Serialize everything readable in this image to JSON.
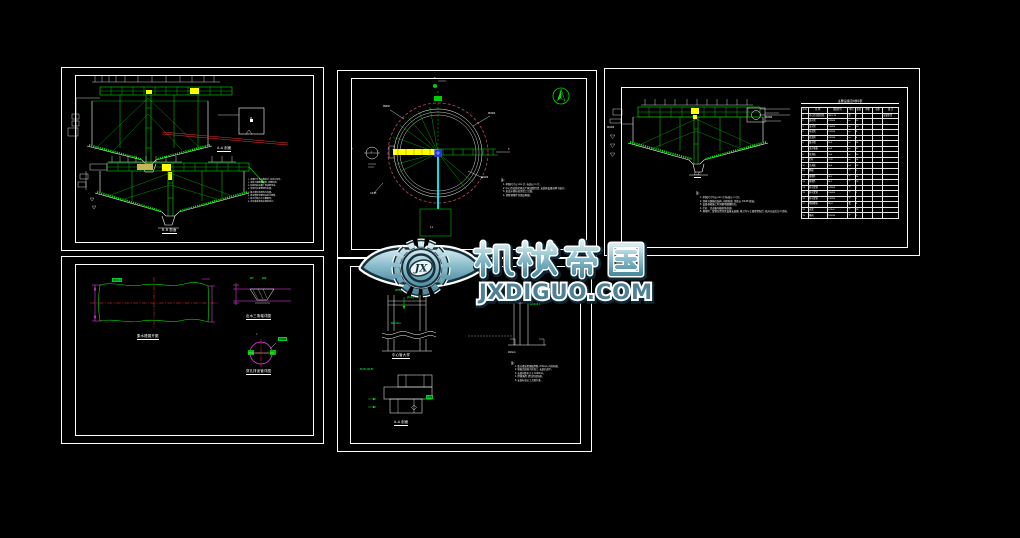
{
  "watermark": {
    "logo_monogram": "JX",
    "brand": "机械帝国",
    "domain": "JXDIGUO.COM",
    "color_main": "#4e8ea6",
    "color_light": "#d8ecf1",
    "color_dark": "#16313c"
  },
  "panels": {
    "p1": {
      "title_top": "A-A 剖面",
      "title_bottom": "B-B 剖面",
      "box_label": "M",
      "notes": [
        "1. 本图尺寸均以毫米计, 标高以米计。",
        "2. 池体为钢筋砼结构, 内壁防腐。",
        "3. 刮泥机由设备厂家成套供货。",
        "4. 安装时注意预埋件位置。",
        "5. 集水槽沿池周均匀布置。",
        "6. 排泥管穿池壁处设防水套管。",
        "7. 施工时请与工艺图配合。",
        "8. 未尽事宜按有关规范执行。"
      ]
    },
    "p2": {
      "cut_label_top": "F",
      "cut_label_left": "T",
      "cut_label_right": "T",
      "detail_box_label": "J-1",
      "section_mark": "1",
      "dims": [
        "DN500",
        "DN200",
        "R9000",
        "i=0.05"
      ],
      "notes_heading": "注:",
      "notes": [
        "1. 本图尺寸以 mm 计, 标高以 m 计。",
        "2. 中心传动刮泥机由厂家成套供货, 安装按设备说明书进行。",
        "3. 进出水管标高详见工艺图。",
        "4. 池壁预埋件详见结构图。"
      ]
    },
    "p3": {
      "section_title": "C-C",
      "dims": [
        "DN500",
        "DN200"
      ],
      "notes_heading": "注:",
      "notes": [
        "1. 本图尺寸均以 mm 计(标高以 m 计)。",
        "2. 池体为钢筋砼结构, 内壁防腐, 池底以 i=0.05 找坡。",
        "3. 设备基础施工时预留地脚螺栓孔。",
        "4. 栏杆、走道板均做防锈处理。",
        "5. 预埋件、套管位置详见设备安装图, 施工时与土建密切配合, 核对无误后方可浇筑。"
      ],
      "table": {
        "title": "主要设备及材料表",
        "headers": [
          "序号",
          "名 称",
          "规格型号",
          "单位",
          "数量",
          "单重",
          "总重",
          "备 注"
        ],
        "rows": [
          [
            "1",
            "中心传动刮泥机",
            "ZBG-18",
            "台",
            "1",
            "",
            "",
            "成套供货"
          ],
          [
            "2",
            "进水管",
            "DN500",
            "m",
            "12",
            "",
            "",
            ""
          ],
          [
            "3",
            "出水管",
            "DN400",
            "m",
            "10",
            "",
            "",
            ""
          ],
          [
            "4",
            "排泥管",
            "DN200",
            "m",
            "8",
            "",
            "",
            ""
          ],
          [
            "5",
            "溢流管",
            "DN150",
            "m",
            "6",
            "",
            "",
            ""
          ],
          [
            "6",
            "集水槽",
            "δ=6",
            "m",
            "56",
            "",
            "",
            ""
          ],
          [
            "7",
            "出水堰板",
            "δ=6",
            "m",
            "57",
            "",
            "",
            ""
          ],
          [
            "8",
            "挡渣板",
            "δ=4",
            "m",
            "56",
            "",
            "",
            ""
          ],
          [
            "9",
            "栏杆",
            "∅32",
            "m",
            "24",
            "",
            "",
            ""
          ],
          [
            "10",
            "走道板",
            "δ=4",
            "m²",
            "18",
            "",
            "",
            ""
          ],
          [
            "11",
            "爬梯",
            "",
            "个",
            "1",
            "",
            "",
            ""
          ],
          [
            "12",
            "预埋件",
            "M-1",
            "个",
            "24",
            "",
            "",
            ""
          ],
          [
            "13",
            "预埋件",
            "M-2",
            "个",
            "16",
            "",
            "",
            ""
          ],
          [
            "14",
            "防水套管",
            "DN500",
            "个",
            "1",
            "",
            "",
            ""
          ],
          [
            "15",
            "防水套管",
            "DN400",
            "个",
            "1",
            "",
            "",
            ""
          ],
          [
            "16",
            "防水套管",
            "DN200",
            "个",
            "2",
            "",
            "",
            ""
          ],
          [
            "17",
            "地脚螺栓",
            "M24",
            "套",
            "8",
            "",
            "",
            ""
          ],
          [
            "18",
            "支架",
            "L63×6",
            "个",
            "28",
            "",
            "",
            ""
          ],
          [
            "19",
            "闸阀",
            "DN200",
            "个",
            "2",
            "",
            "",
            ""
          ]
        ]
      }
    },
    "p4": {
      "title_plate": "集水槽展开图",
      "title_weir": "出水三角堰详图",
      "title_pipe": "穿孔排泥管详图",
      "tag_plate": "650×4",
      "tag_weir_angle": "90°",
      "tag_weir_h": "200",
      "tag_pipe": "DN80",
      "eq_mark": "="
    },
    "p5": {
      "wall_tags": [
        "∅25@200",
        "∅12@150"
      ],
      "dim_green": "600 mm",
      "title_a": "中心管大样",
      "pipe_tags": [
        "∅108×4",
        "∅89×4",
        "∅60×3.5"
      ],
      "label_b": "400mm",
      "bottom_tags": "50 50 120 50",
      "tag_right": "C20",
      "title_c": "A-A 剖面",
      "notes_heading": "注:",
      "notes": [
        "1. 集水槽采用钢板焊制, δ=6mm, 内外防腐。",
        "2. 堰板齿形按大样加工, 安装后调平。",
        "3. 支架间距不大于 1000mm。",
        "4. 焊缝满焊, 焊后除渣防腐。",
        "5. 安装标高以工艺图为准。"
      ]
    }
  }
}
